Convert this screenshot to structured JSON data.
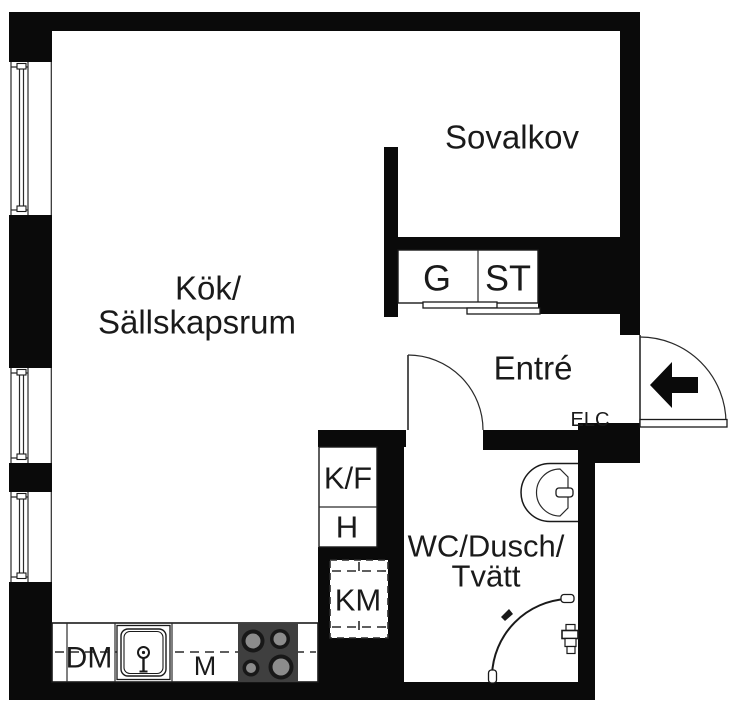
{
  "colors": {
    "wall": "#0a0a0a",
    "floor": "#ffffff",
    "stove_body": "#3f3f3f",
    "burner_ring": "#181818",
    "burner_center": "#8c8c8c"
  },
  "plan": {
    "kitchen": {
      "line1": "Kök/",
      "line2": "Sällskapsrum",
      "counter": {
        "dm": "DM",
        "m": "M"
      }
    },
    "sleeping_alcove": {
      "label": "Sovalkov"
    },
    "closets": {
      "g": "G",
      "st": "ST"
    },
    "entry": {
      "label": "Entré",
      "elc": "ELC"
    },
    "utility": {
      "fridge_freezer": "K/F",
      "shelf": "H",
      "washing_machine": "KM"
    },
    "bathroom": {
      "line1": "WC/Dusch/",
      "line2": "Tvätt"
    }
  }
}
